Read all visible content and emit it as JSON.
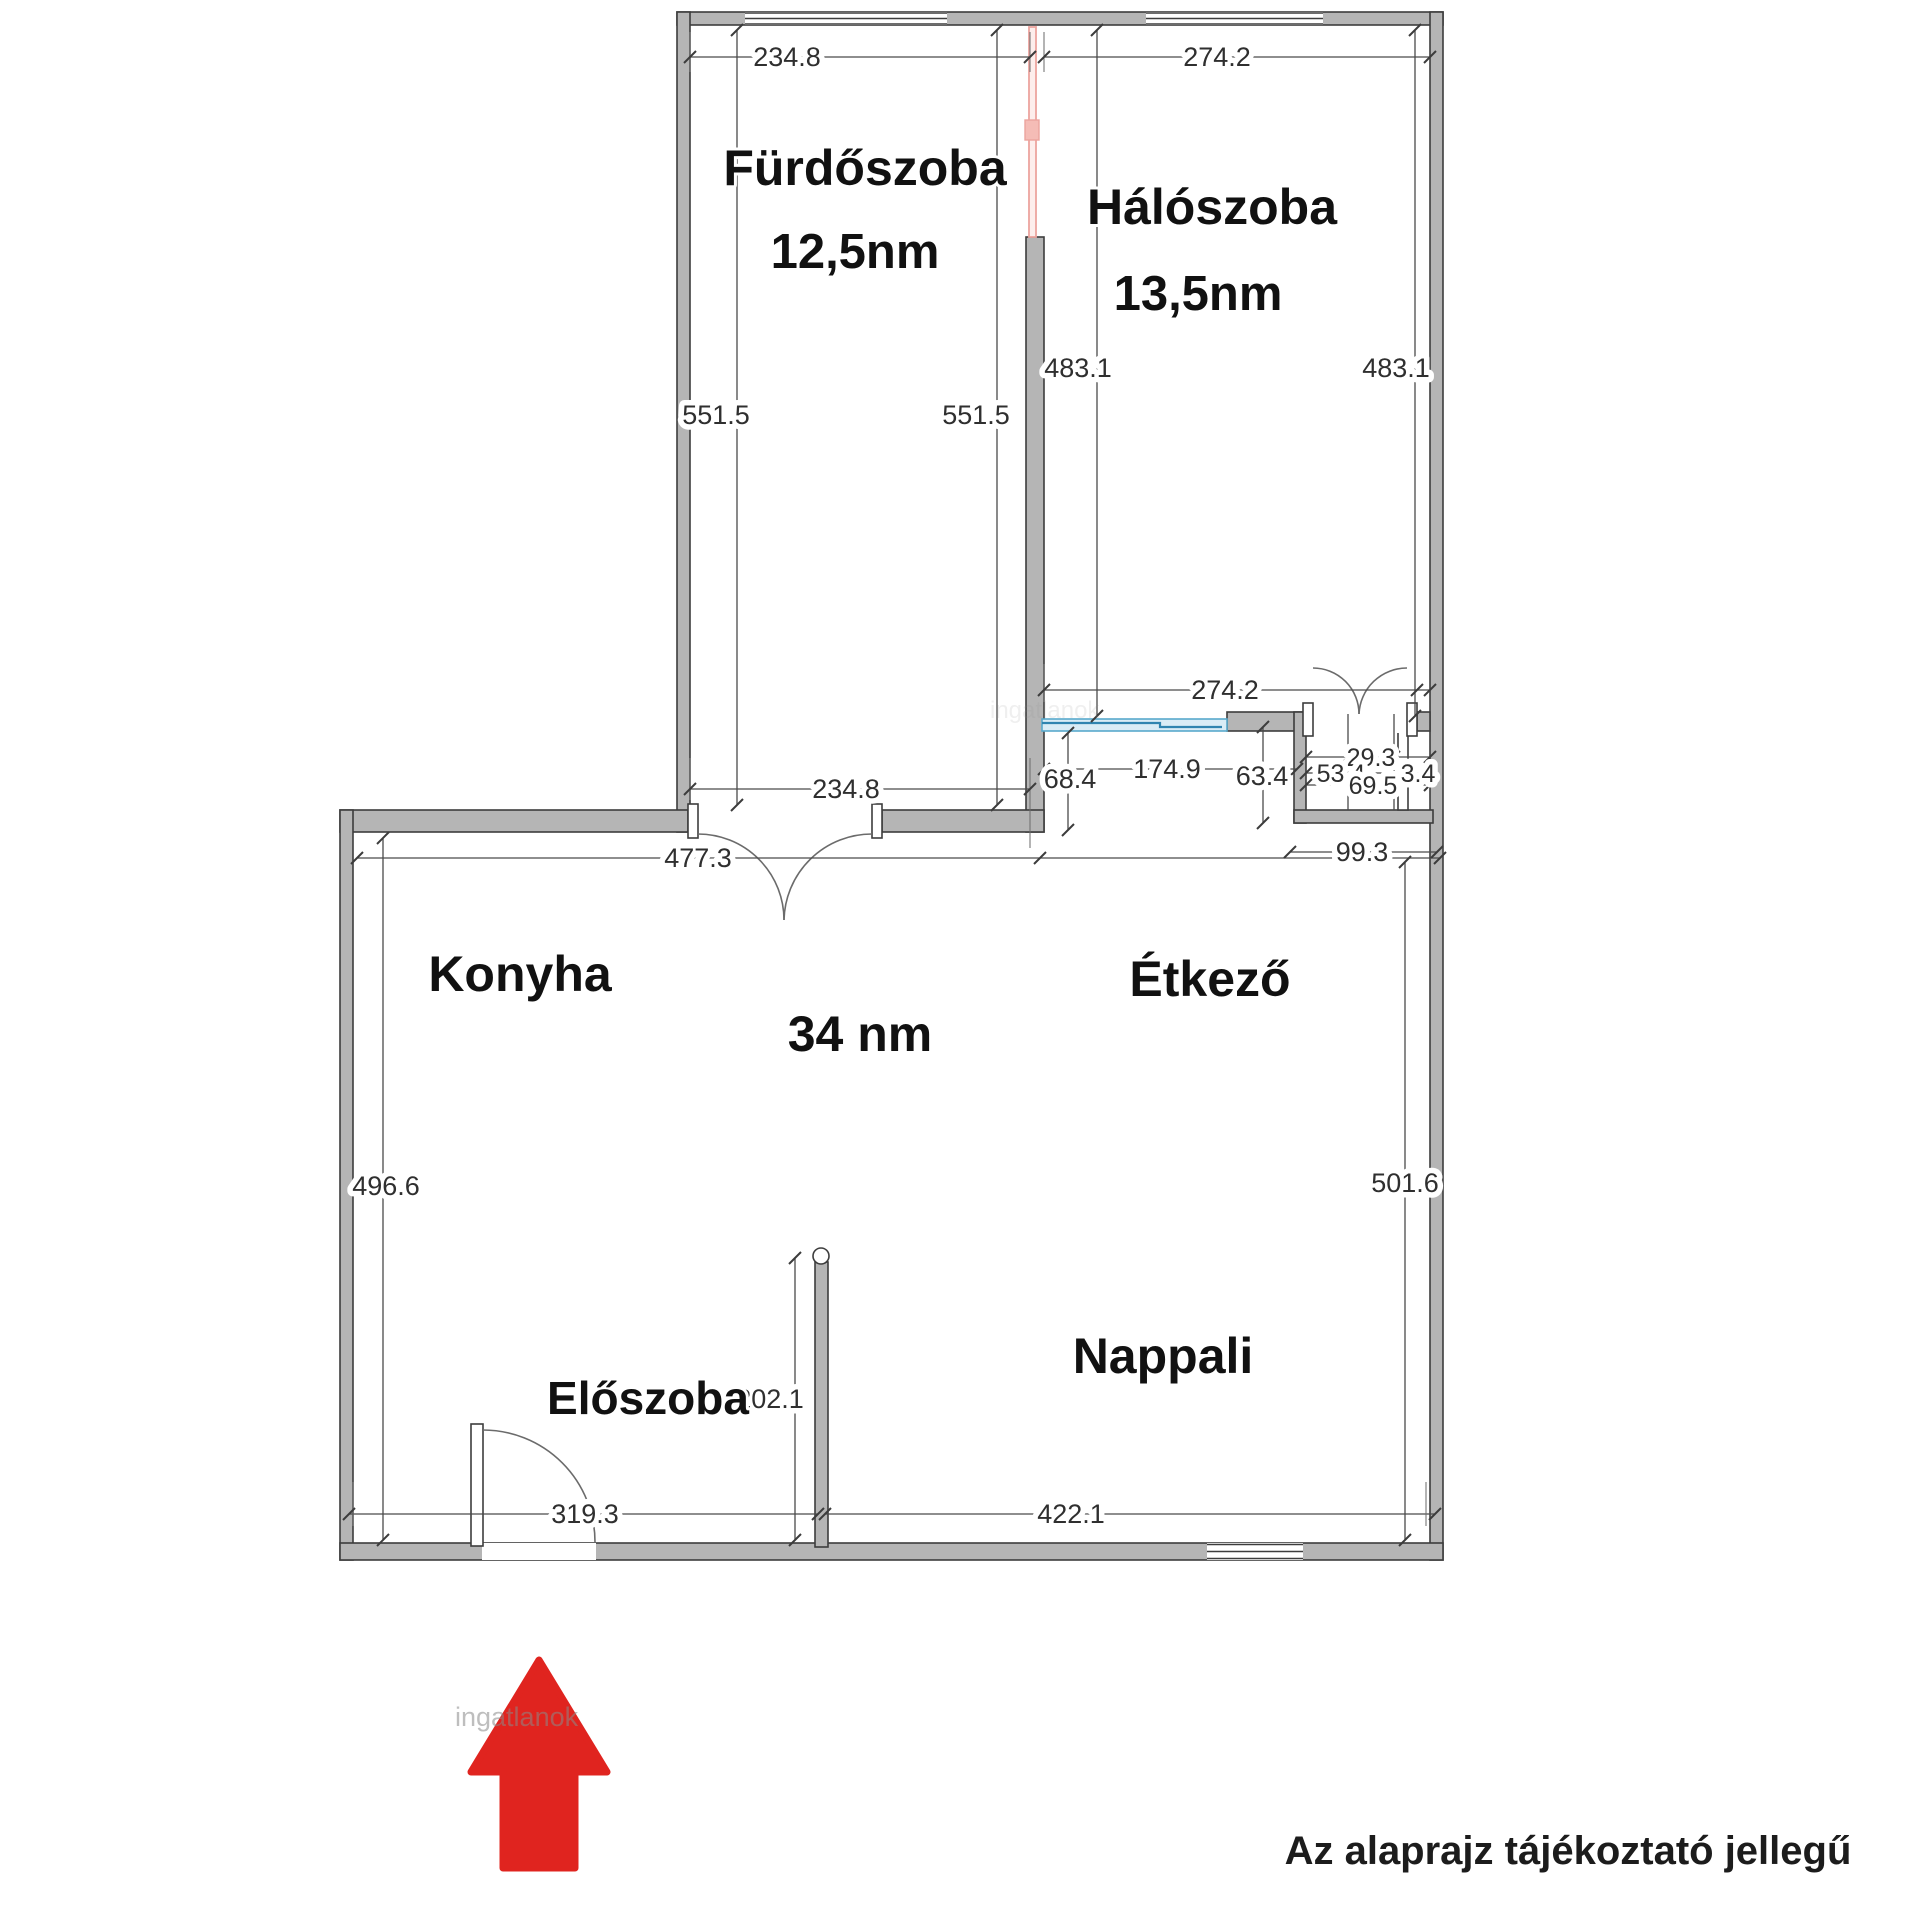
{
  "plan": {
    "rooms": {
      "bathroom": {
        "name": "Fürdőszoba",
        "area": "12,5nm"
      },
      "bedroom": {
        "name": "Hálószoba",
        "area": "13,5nm"
      },
      "kitchen": {
        "name": "Konyha"
      },
      "dining": {
        "name": "Étkező"
      },
      "living": {
        "name": "Nappali"
      },
      "hall": {
        "name": "Előszoba"
      },
      "open_area_total": "34 nm"
    },
    "dims": {
      "bath_top": "234.8",
      "bed_top": "274.2",
      "bath_left": "551.5",
      "bath_right": "551.5",
      "bed_left": "483.1",
      "bed_right": "483.1",
      "bed_bottom": "274.2",
      "pass": "174.9",
      "n68": "68.4",
      "n63": "63.4",
      "n29": "29.3",
      "n53": "53.4",
      "n69": "69.5",
      "n3": "3.4",
      "closet": "99.3",
      "bath_bottom": "234.8",
      "mid": "477.3",
      "kitchen_left": "496.6",
      "living_right": "501.6",
      "hall_wall": "202.1",
      "hall_bottom": "319.3",
      "living_bottom": "422.1"
    },
    "caption": "Az alaprajz tájékoztató jellegű",
    "watermark": "ingatlanok",
    "colors": {
      "wall": "#b5b5b5",
      "wall_edge": "#3d3d3d",
      "dim_text": "#2f2f2f",
      "accent_pink": "#eca49e",
      "accent_blue": "#58a9cc",
      "arrow_red": "#e0241f"
    }
  }
}
